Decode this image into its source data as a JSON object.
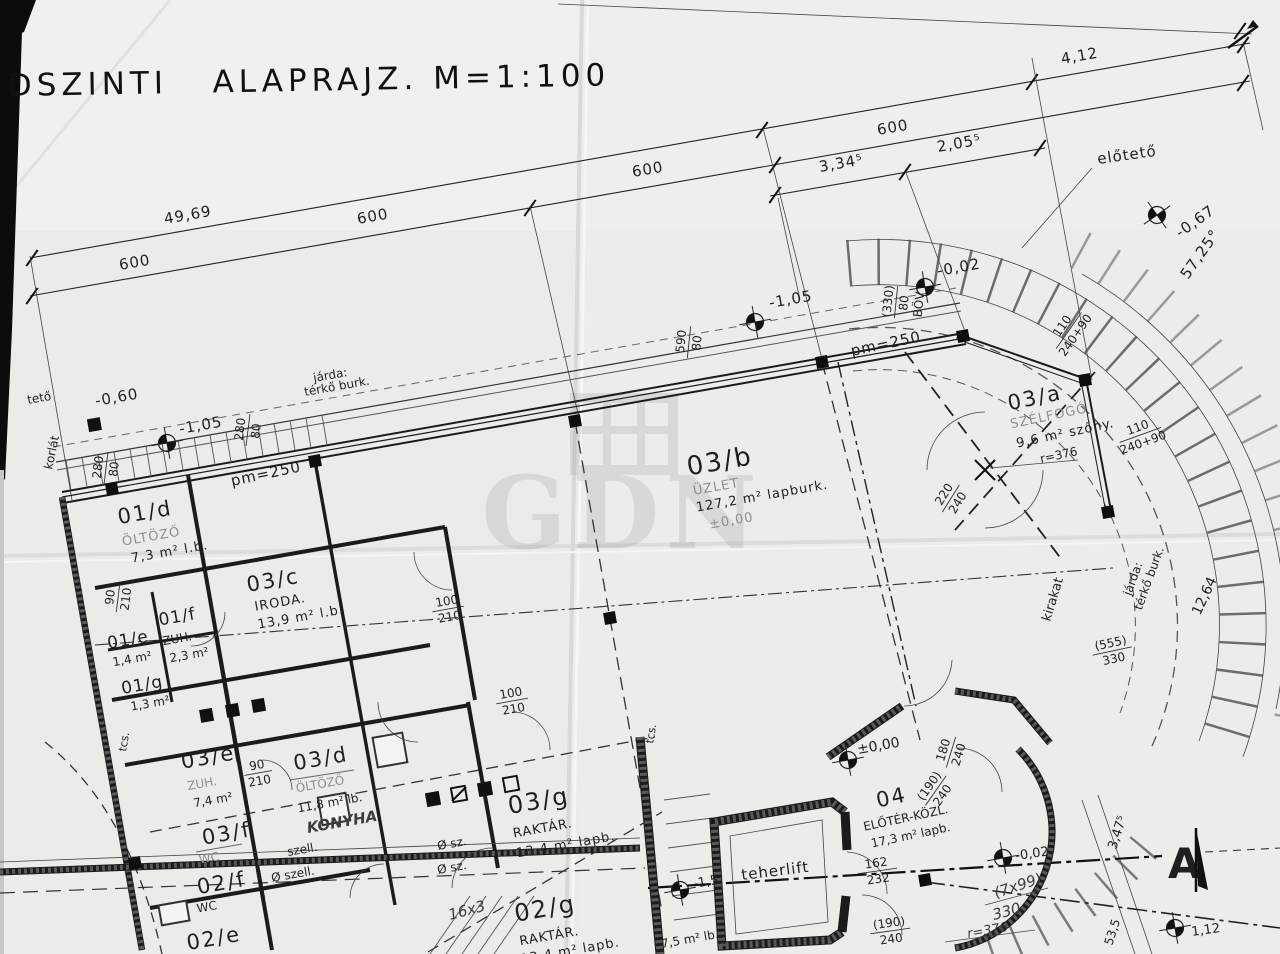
{
  "title": "DSZINTI   ALAPRAJZ. M=1:100",
  "watermark": "GDN",
  "dims": {
    "overall": "49,69",
    "seg600a": "600",
    "seg600b": "600",
    "seg600c": "600",
    "seg600d": "600",
    "seg334": "3,34⁵",
    "seg205": "2,05⁵",
    "seg412": "4,12",
    "angle": "57,25°",
    "r376a": "r=376",
    "r376b": "r=376",
    "d330": "330",
    "steps": "16x3",
    "steps2": "(7x99)",
    "d347": "3,47⁵",
    "d1264": "12,64",
    "d535": "53,5",
    "p112": "1,12"
  },
  "levels": {
    "m060": "-0,60",
    "m105a": "-1,05",
    "m105b": "-1,05",
    "m067": "-0,67",
    "m002a": "-0,02",
    "m002b": "-0,02",
    "zero_a": "±0,00",
    "zero_b": "±0,00",
    "m15": "-1,5"
  },
  "openings": {
    "o280a": {
      "num": "280",
      "den": "80"
    },
    "o280b": {
      "num": "280",
      "den": "80"
    },
    "o590": {
      "num": "590",
      "den": "80"
    },
    "o330": {
      "num": "(330)",
      "den": "80",
      "note": "BÖV"
    },
    "o100a": {
      "num": "100",
      "den": "210"
    },
    "o100b": {
      "num": "100",
      "den": "210"
    },
    "o90a": {
      "num": "90",
      "den": "210"
    },
    "o90b": {
      "num": "90",
      "den": "210"
    },
    "o110a": {
      "num": "110",
      "den": "240+90"
    },
    "o110b": {
      "num": "110",
      "den": "240+90"
    },
    "o220": {
      "num": "220",
      "den": "240"
    },
    "o180": {
      "num": "180",
      "den": "240"
    },
    "o190a": {
      "num": "(190)",
      "den": "240"
    },
    "o190b": {
      "num": "(190)",
      "den": "240"
    },
    "o162": {
      "num": "162",
      "den": "232"
    },
    "o555": {
      "num": "(555)",
      "den": "330"
    }
  },
  "notes": {
    "pm250a": "pm=250",
    "pm250b": "pm=250"
  },
  "rooms": {
    "r01d": {
      "id": "01/d",
      "name": "ÖLTÖZŐ",
      "area": "7,3 m² l.b."
    },
    "r01e": {
      "id": "01/e",
      "area": "1,4 m²"
    },
    "r01f": {
      "id": "01/f",
      "name": "ZUH.",
      "area": "2,3 m²"
    },
    "r01g": {
      "id": "01/g",
      "area": "1,3 m²"
    },
    "r03c": {
      "id": "03/c",
      "name": "IRODA.",
      "area": "13,9 m² l.b."
    },
    "r03b": {
      "id": "03/b",
      "name": "ÜZLET",
      "area": "127,2 m² lapburk."
    },
    "r03a": {
      "id": "03/a",
      "name": "SZÉLFOGÓ",
      "area": "9,6 m² szőny."
    },
    "r03e": {
      "id": "03/e",
      "name": "ZUH.",
      "area": "7,4 m²"
    },
    "r03d": {
      "id": "03/d",
      "name": "ÖLTÖZŐ",
      "area": "11,8 m² lb.",
      "extra": "KONYHA"
    },
    "r03f": {
      "id": "03/f",
      "name": "WC"
    },
    "r03g": {
      "id": "03/g",
      "name": "RAKTÁR.",
      "area": "13,4 m² lapb."
    },
    "r02g": {
      "id": "02/g",
      "name": "RAKTÁR.",
      "area": "13,4 m² lapb."
    },
    "r02f": {
      "id": "02/f",
      "name": "WC"
    },
    "r02e": {
      "id": "02/e"
    },
    "r04": {
      "id": "04",
      "name": "ELŐTÉR-KÖZL.",
      "area": "17,3 m² lapb."
    }
  },
  "labels": {
    "elotato": "előtető",
    "teto": "tető",
    "korlat": "korlát",
    "kirakat": "kirakat",
    "tcs_a": "tcs.",
    "tcs_b": "tcs.",
    "szell_a": "szell.",
    "szell_b": "Ø szell.",
    "osz_a": "Ø sz.",
    "osz_b": "Ø sz.",
    "jarda1_l1": "járda:",
    "jarda1_l2": "térkő burk.",
    "jarda2_l1": "járda:",
    "jarda2_l2": "térkő burk.",
    "lift": "teherlift",
    "extra75": "7,5 m² lb.",
    "section": "A"
  }
}
